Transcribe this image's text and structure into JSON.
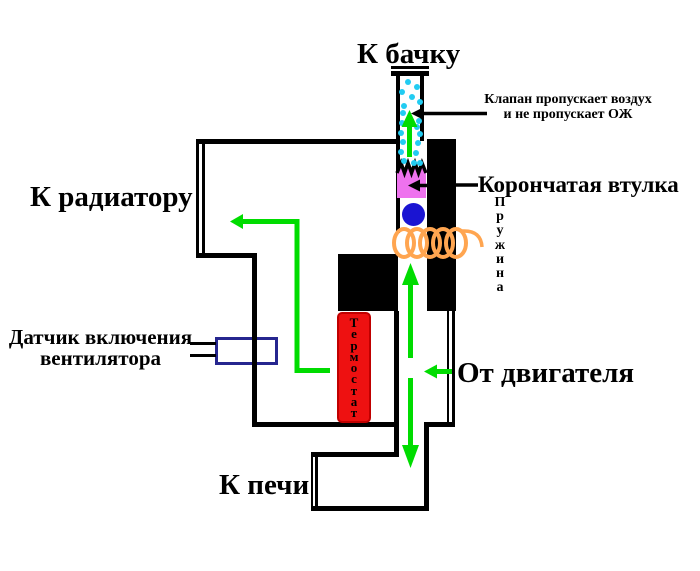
{
  "diagram": {
    "labels": {
      "to_tank": "К бачку",
      "to_radiator": "К радиатору",
      "from_engine": "От двигателя",
      "to_stove": "К печи",
      "crown_bushing": "Корончатая втулка",
      "valve_note": {
        "line1": "Клапан пропускает воздух",
        "line2": "и не пропускает ОЖ"
      },
      "fan_sensor": {
        "line1": "Датчик включения",
        "line2": "вентилятора"
      },
      "spring": {
        "word": "Пружина",
        "letters": [
          "П",
          "р",
          "у",
          "ж",
          "и",
          "н",
          "а"
        ]
      },
      "thermostat": {
        "word": "Термостат",
        "letters": [
          "Т",
          "е",
          "р",
          "м",
          "о",
          "с",
          "т",
          "а",
          "т"
        ]
      }
    },
    "colors": {
      "flow_arrow": "#00dc00",
      "air_bubble": "#22ccf2",
      "crown_bushing_fill": "#ee72ee",
      "valve_ball": "#1a14d2",
      "spring": "#ffa550",
      "thermostat_fill": "#ee1111",
      "thermostat_border": "#c00000",
      "sensor_box_border": "#26268f",
      "outline": "#000000"
    }
  }
}
